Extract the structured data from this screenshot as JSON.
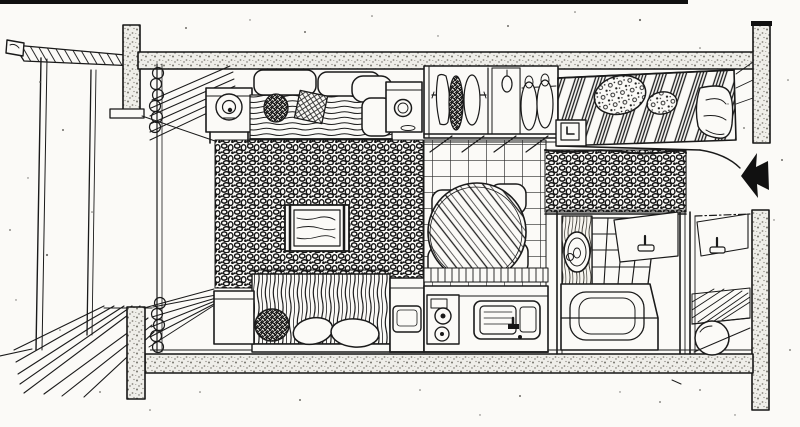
{
  "meta": {
    "title": "Hand-drawn one-room apartment floor plan, cutaway axonometric pen-and-ink sketch",
    "paper_color": "#fbfaf7",
    "ink_color": "#1a1a1a",
    "wall_speckle_color": "#807d75"
  },
  "rooms": {
    "balcony": {
      "label": "Balcony with plank deck and railing"
    },
    "living": {
      "label": "Living and sleeping area with dark shag rug"
    },
    "kitchen": {
      "label": "Kitchen and dining area with tiled floor"
    },
    "hall": {
      "label": "Entry hall with dark mat"
    },
    "bathroom": {
      "label": "Bathroom"
    },
    "utility": {
      "label": "Utility room with duckboard floor"
    }
  },
  "furniture": {
    "curtain": {
      "label": "Curtain with rings and venetian blind"
    },
    "sofa": {
      "label": "Sofa with cushions and striped throw"
    },
    "end_table": {
      "label": "End table with round lamp"
    },
    "side_table": {
      "label": "Side cabinet with dish"
    },
    "tv": {
      "label": "Television set on rug"
    },
    "bed_lower": {
      "label": "Bed with striped cover and pillows"
    },
    "nightstand_lower": {
      "label": "Bedside cube"
    },
    "closet": {
      "label": "Open wardrobe with hanging clothes"
    },
    "dining_table": {
      "label": "Round dining table with striped cloth and four chairs"
    },
    "appliance": {
      "label": "Under-counter appliance with hatch"
    },
    "stove": {
      "label": "Two-burner stove"
    },
    "sink": {
      "label": "Kitchen sink with faucet"
    },
    "bed_upper": {
      "label": "Bed with diagonally striped duvet and patterned pillows"
    },
    "nightstand_clock": {
      "label": "Bedside table with clock"
    },
    "vanity": {
      "label": "Washstand with round mirror"
    },
    "bathtub": {
      "label": "Bathtub"
    },
    "wash_tub": {
      "label": "Round wash tub"
    }
  },
  "annotations": {
    "entrance_arrow": {
      "label": "Entrance direction arrow"
    }
  }
}
